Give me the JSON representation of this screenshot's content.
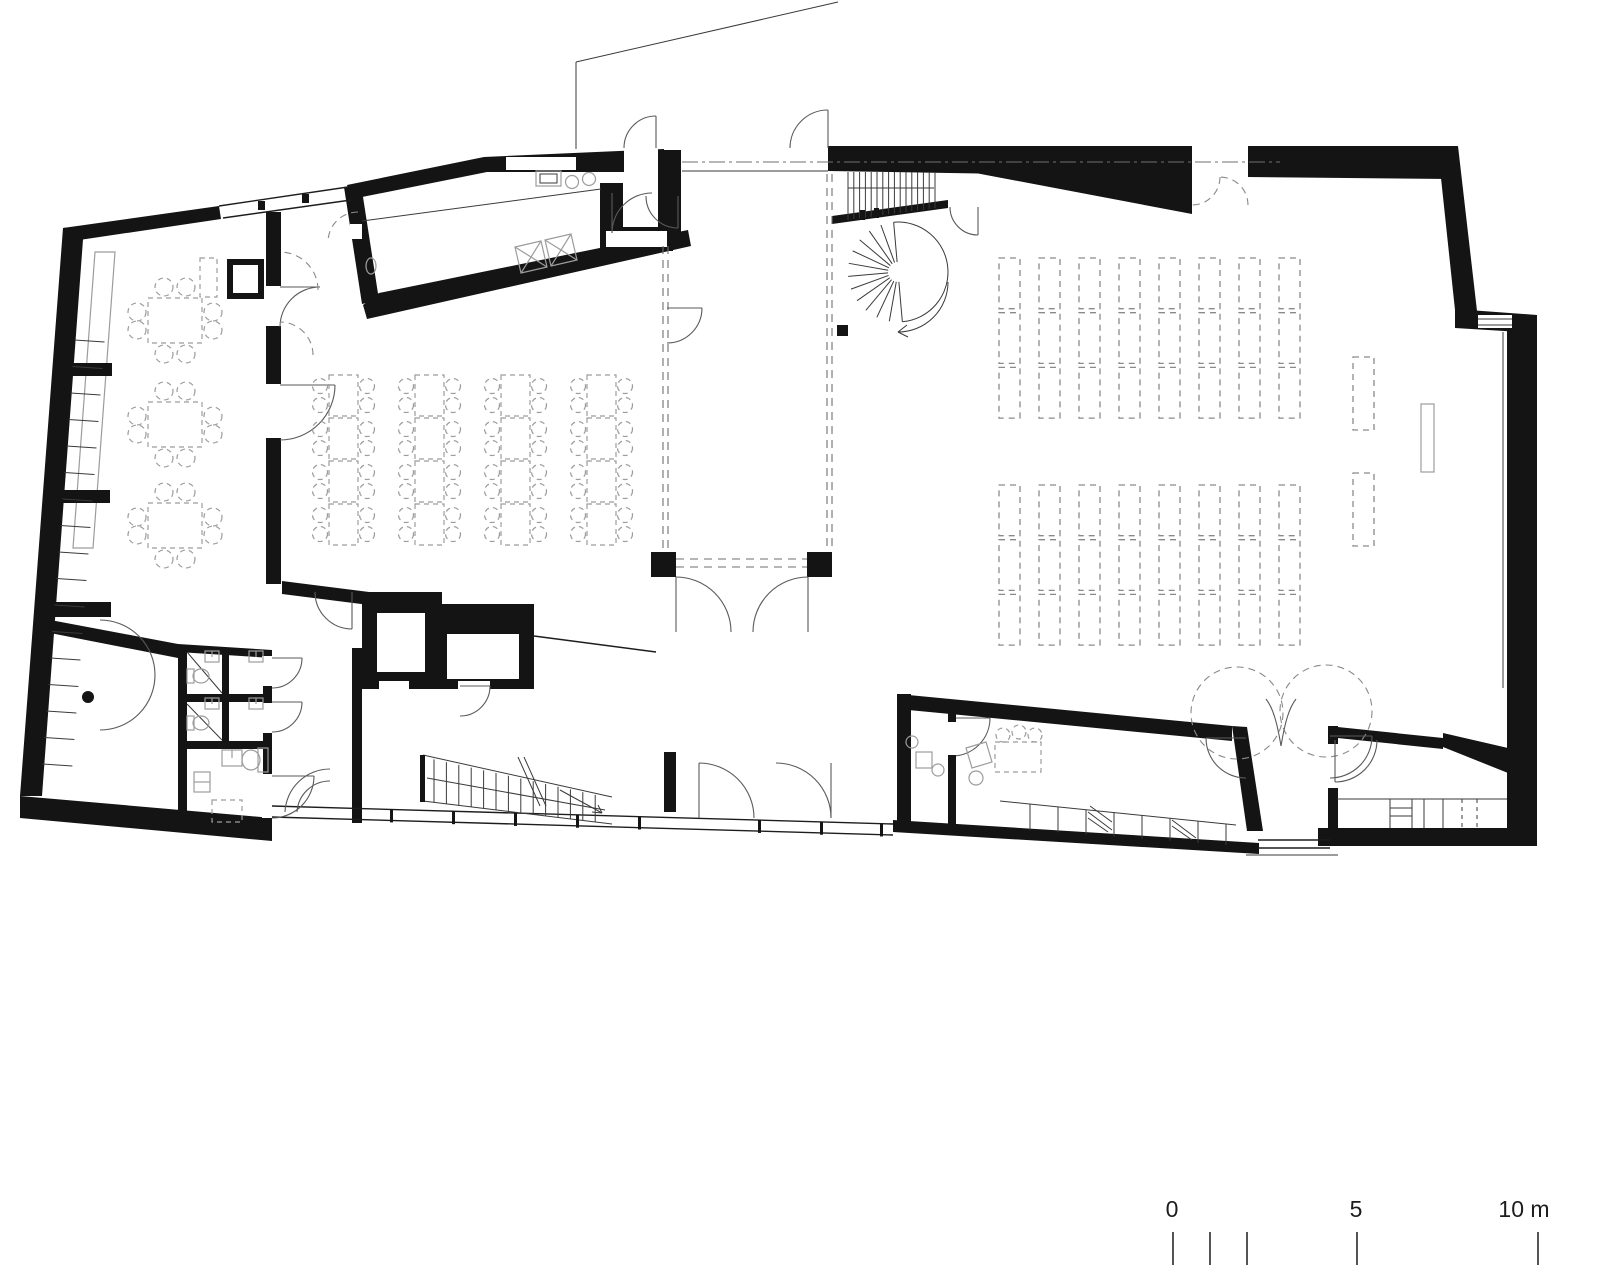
{
  "drawing": {
    "type": "architectural-floor-plan",
    "sheet_background": "#ffffff",
    "wall_color": "#141414",
    "furniture_color": "#9c9c9c",
    "pew_color": "#8a8a8a"
  },
  "scale_bar": {
    "labels": [
      {
        "text": "0",
        "x": 1172
      },
      {
        "text": "5",
        "x": 1356
      },
      {
        "text": "10 m",
        "x": 1524
      }
    ],
    "label_y": 1196,
    "ticks_x": [
      1172,
      1209,
      1246,
      1356,
      1537
    ],
    "tick_top": 1232,
    "tick_height": 33
  },
  "plan": {
    "pew_blocks": [
      {
        "x0": 999,
        "y0": 258,
        "cols": 8,
        "col_pitch": 40,
        "bench_w": 21,
        "rows": 3,
        "row_h": 54.7
      },
      {
        "x0": 999,
        "y0": 485,
        "cols": 8,
        "col_pitch": 40,
        "bench_w": 21,
        "rows": 3,
        "row_h": 54.7
      }
    ],
    "side_benches": [
      {
        "x": 1353,
        "y": 357,
        "w": 21,
        "h": 73
      },
      {
        "x": 1353,
        "y": 473,
        "w": 21,
        "h": 73
      }
    ],
    "lectern": {
      "x": 1421,
      "y": 404,
      "w": 13,
      "h": 68
    },
    "seminar_tables": {
      "col_x": [
        329,
        415,
        501,
        587
      ],
      "row_y": [
        375,
        418,
        461,
        504
      ],
      "w": 29,
      "h": 41,
      "chair_r": 7.5,
      "chair_dy": [
        11,
        30
      ],
      "chair_dx": 9
    },
    "dining_tables": {
      "x": 148,
      "ys": [
        298,
        402,
        503
      ],
      "w": 54,
      "h": 45,
      "chair_r": 9
    },
    "serving_table": {
      "x": 200,
      "y": 258,
      "w": 17,
      "h": 39
    },
    "foyer_stair": {
      "x0": 434,
      "n": 14,
      "dx": 12.4,
      "top_y0": 757,
      "top_slope": 0.22,
      "bot_y0": 801,
      "bot_slope": 0.12
    },
    "hall_stair": {
      "x0": 848,
      "n": 16,
      "dx": 5.8,
      "y_top": 172,
      "bot_y0": 222,
      "bot_slope": 0.135
    },
    "spiral_stair": {
      "cx": 898,
      "cy": 272,
      "r_in": 10,
      "r_out": 50,
      "a_start": 95,
      "a_end": 275,
      "step_deg": 15
    },
    "facade_mullions": {
      "xs": [
        390,
        452,
        514,
        576,
        638,
        758,
        820,
        880
      ],
      "y0": 806,
      "slope": 0.0287,
      "w": 3,
      "h": 13
    },
    "window_rungs": {
      "count": 17,
      "y0": 340,
      "dy": 26.5,
      "x_at_228": 83,
      "slope": 0.0758,
      "len": 30
    },
    "office_counter_xs": [
      1030,
      1058,
      1086,
      1114,
      1142,
      1170,
      1198,
      1226
    ],
    "wc_rows_y": [
      650,
      698
    ]
  }
}
